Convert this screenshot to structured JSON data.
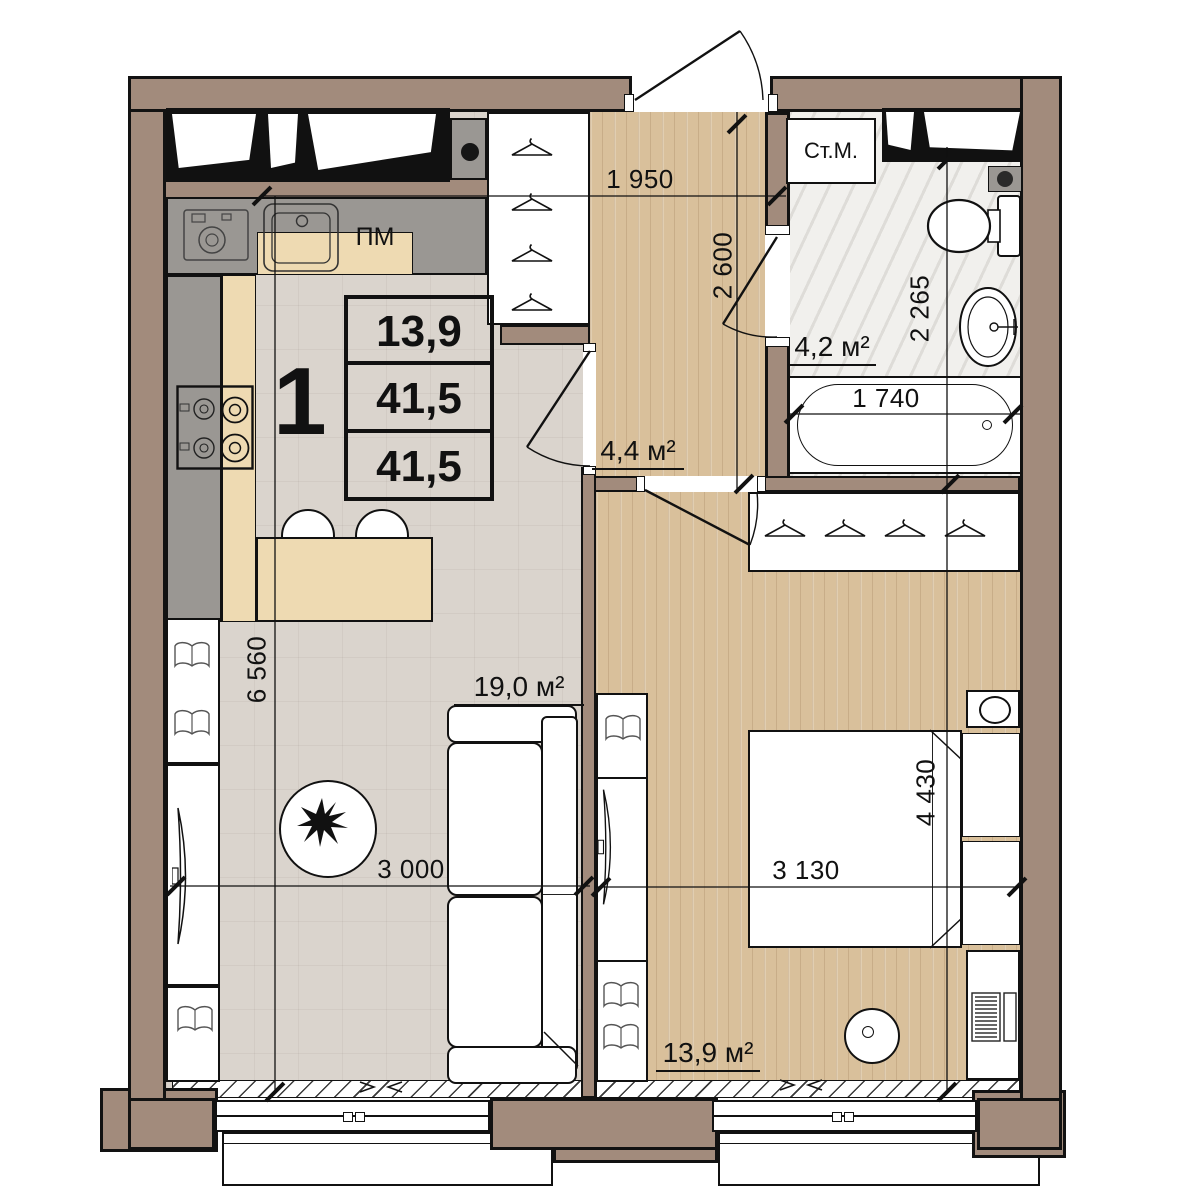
{
  "stamp": {
    "rooms_count": "1",
    "living_area": "13,9",
    "total_area": "41,5",
    "total_area_reduced": "41,5"
  },
  "rooms": {
    "kitchen_living_area": "19,0 м²",
    "bedroom_area": "13,9 м²",
    "hallway_area": "4,4 м²",
    "bathroom_area": "4,2 м²"
  },
  "appliances": {
    "washing_machine": "Ст.М.",
    "dishwasher": "ПМ"
  },
  "dimensions": {
    "hallway_width": "1 950",
    "hallway_depth": "2 600",
    "bathroom_depth": "2 265",
    "bathtub_length": "1 740",
    "living_depth": "6 560",
    "living_width": "3 000",
    "bedroom_width": "3 130",
    "bedroom_depth": "4 430"
  },
  "colors": {
    "wall": "#a28b7c",
    "outline": "#121212",
    "wood": "#d9c09b",
    "tile": "#dad4cd",
    "marble": "#f1f0ed",
    "gray": "#9a9793",
    "beige": "#eedab2"
  }
}
